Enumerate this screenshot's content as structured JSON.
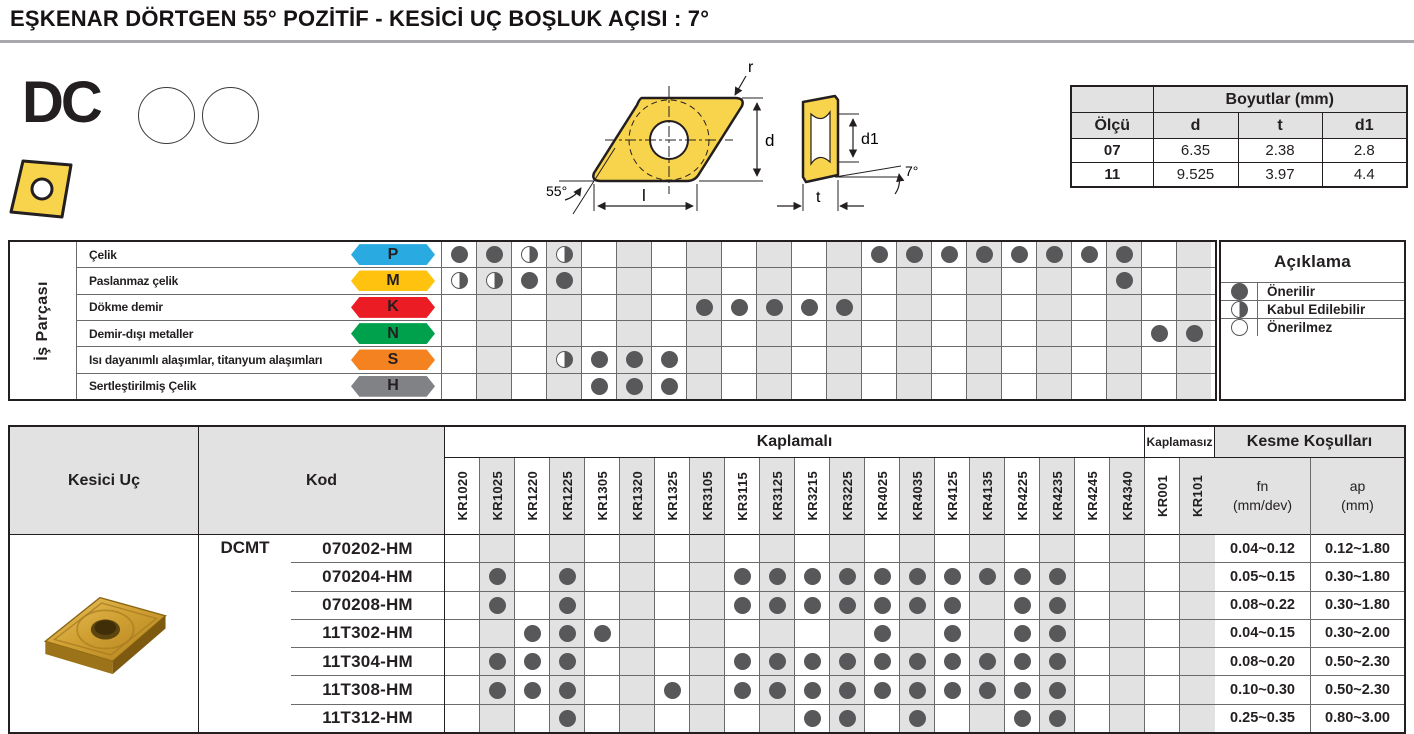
{
  "title": "EŞKENAR DÖRTGEN 55° POZİTİF - KESİCİ UÇ BOŞLUK AÇISI : 7°",
  "product": {
    "code": "DC"
  },
  "diagram": {
    "labels": {
      "r": "r",
      "d": "d",
      "l": "l",
      "deg55": "55°",
      "d1": "d1",
      "t": "t",
      "deg7": "7°"
    }
  },
  "dimensions_table": {
    "title": "Boyutlar (mm)",
    "col_headers": {
      "size": "Ölçü",
      "d": "d",
      "t": "t",
      "d1": "d1"
    },
    "rows": [
      {
        "olcu": "07",
        "d": "6.35",
        "t": "2.38",
        "d1": "2.8"
      },
      {
        "olcu": "11",
        "d": "9.525",
        "t": "3.97",
        "d1": "4.4"
      }
    ]
  },
  "grades": [
    "KR1020",
    "KR1025",
    "KR1220",
    "KR1225",
    "KR1305",
    "KR1320",
    "KR1325",
    "KR3105",
    "KR3115",
    "KR3125",
    "KR3215",
    "KR3225",
    "KR4025",
    "KR4035",
    "KR4125",
    "KR4135",
    "KR4225",
    "KR4235",
    "KR4245",
    "KR4340",
    "KR001",
    "KR101"
  ],
  "material_matrix": {
    "axis_label": "İş Parçası",
    "rows": [
      {
        "label": "Çelik",
        "letter": "P",
        "color": "#29ABE2",
        "cells": {
          "KR1020": "F",
          "KR1025": "F",
          "KR1220": "H",
          "KR1225": "H",
          "KR4025": "F",
          "KR4035": "F",
          "KR4125": "F",
          "KR4135": "F",
          "KR4225": "F",
          "KR4235": "F",
          "KR4245": "F",
          "KR4340": "F"
        }
      },
      {
        "label": "Paslanmaz çelik",
        "letter": "M",
        "color": "#FFC20E",
        "cells": {
          "KR1020": "H",
          "KR1025": "H",
          "KR1220": "F",
          "KR1225": "F",
          "KR4340": "F"
        }
      },
      {
        "label": "Dökme demir",
        "letter": "K",
        "color": "#EC1C24",
        "cells": {
          "KR3105": "F",
          "KR3115": "F",
          "KR3125": "F",
          "KR3215": "F",
          "KR3225": "F"
        }
      },
      {
        "label": "Demir-dışı metaller",
        "letter": "N",
        "color": "#00A14C",
        "cells": {
          "KR001": "F",
          "KR101": "F"
        }
      },
      {
        "label": "Isı dayanımlı alaşımlar, titanyum alaşımları",
        "letter": "S",
        "color": "#F58220",
        "cells": {
          "KR1225": "H",
          "KR1305": "F",
          "KR1320": "F",
          "KR1325": "F"
        }
      },
      {
        "label": "Sertleştirilmiş Çelik",
        "letter": "H",
        "color": "#808285",
        "cells": {
          "KR1305": "F",
          "KR1320": "F",
          "KR1325": "F"
        }
      }
    ]
  },
  "legend": {
    "title": "Açıklama",
    "items": [
      {
        "symbol": "full",
        "label": "Önerilir"
      },
      {
        "symbol": "half",
        "label": "Kabul Edilebilir"
      },
      {
        "symbol": "empty",
        "label": "Önerilmez"
      }
    ]
  },
  "insert_table": {
    "headers": {
      "kesici_uc": "Kesici Uç",
      "kod": "Kod",
      "kaplamali": "Kaplamalı",
      "kaplamasiz": "Kaplamasız",
      "kesme": "Kesme Koşulları",
      "fn": "fn",
      "fn_unit": "(mm/dev)",
      "ap": "ap",
      "ap_unit": "(mm)"
    },
    "series": "DCMT",
    "rows": [
      {
        "code": "070202-HM",
        "dots": [],
        "fn": "0.04~0.12",
        "ap": "0.12~1.80"
      },
      {
        "code": "070204-HM",
        "dots": [
          "KR1025",
          "KR1225",
          "KR3115",
          "KR3125",
          "KR3215",
          "KR3225",
          "KR4025",
          "KR4035",
          "KR4125",
          "KR4135",
          "KR4225",
          "KR4235"
        ],
        "fn": "0.05~0.15",
        "ap": "0.30~1.80"
      },
      {
        "code": "070208-HM",
        "dots": [
          "KR1025",
          "KR1225",
          "KR3115",
          "KR3125",
          "KR3215",
          "KR3225",
          "KR4025",
          "KR4035",
          "KR4125",
          "KR4225",
          "KR4235"
        ],
        "fn": "0.08~0.22",
        "ap": "0.30~1.80"
      },
      {
        "code": "11T302-HM",
        "dots": [
          "KR1220",
          "KR1225",
          "KR1305",
          "KR4025",
          "KR4125",
          "KR4225",
          "KR4235"
        ],
        "fn": "0.04~0.15",
        "ap": "0.30~2.00"
      },
      {
        "code": "11T304-HM",
        "dots": [
          "KR1025",
          "KR1220",
          "KR1225",
          "KR3115",
          "KR3125",
          "KR3215",
          "KR3225",
          "KR4025",
          "KR4035",
          "KR4125",
          "KR4135",
          "KR4225",
          "KR4235"
        ],
        "fn": "0.08~0.20",
        "ap": "0.50~2.30"
      },
      {
        "code": "11T308-HM",
        "dots": [
          "KR1025",
          "KR1220",
          "KR1225",
          "KR1325",
          "KR3115",
          "KR3125",
          "KR3215",
          "KR3225",
          "KR4025",
          "KR4035",
          "KR4125",
          "KR4135",
          "KR4225",
          "KR4235"
        ],
        "fn": "0.10~0.30",
        "ap": "0.50~2.30"
      },
      {
        "code": "11T312-HM",
        "dots": [
          "KR1225",
          "KR3215",
          "KR3225",
          "KR4035",
          "KR4225",
          "KR4235"
        ],
        "fn": "0.25~0.35",
        "ap": "0.80~3.00"
      }
    ]
  }
}
